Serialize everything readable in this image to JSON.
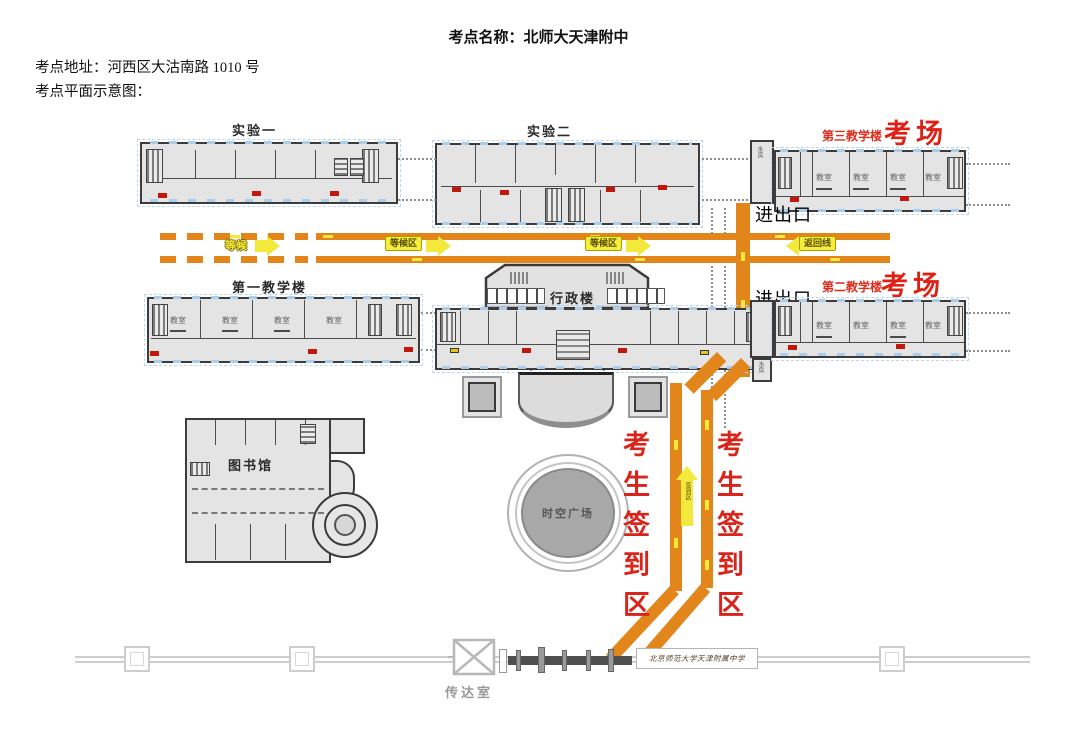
{
  "header": {
    "title": "考点名称：北师大天津附中",
    "address": "考点地址：河西区大沽南路 1010 号",
    "caption": "考点平面示意图："
  },
  "map": {
    "buildings": {
      "lab1": "实验一",
      "lab2": "实验二",
      "teaching1": "第一教学楼",
      "teaching2": "第二教学楼",
      "teaching3": "第三教学楼",
      "exam_hall": "考场",
      "admin": "行政楼",
      "library": "图书馆",
      "plaza": "时空广场",
      "gatehouse": "传达室"
    },
    "labels": {
      "entrance_exit": "进出口",
      "waiting": "等候",
      "waiting_area": "等候区",
      "return_route": "返回线",
      "signin_column": "考生签到区",
      "signin_arrow": "签到区",
      "classroom": "教室",
      "water_room": "水房",
      "gate_sign": "北京师范大学天津附属中学"
    },
    "colors": {
      "route_orange": "#e2861c",
      "arrow_yellow": "#f2e93c",
      "red_text": "#df2014",
      "building_fill": "#e4e4e4",
      "building_outline": "#3c3c3c",
      "window_blue": "#a9cdea"
    }
  }
}
